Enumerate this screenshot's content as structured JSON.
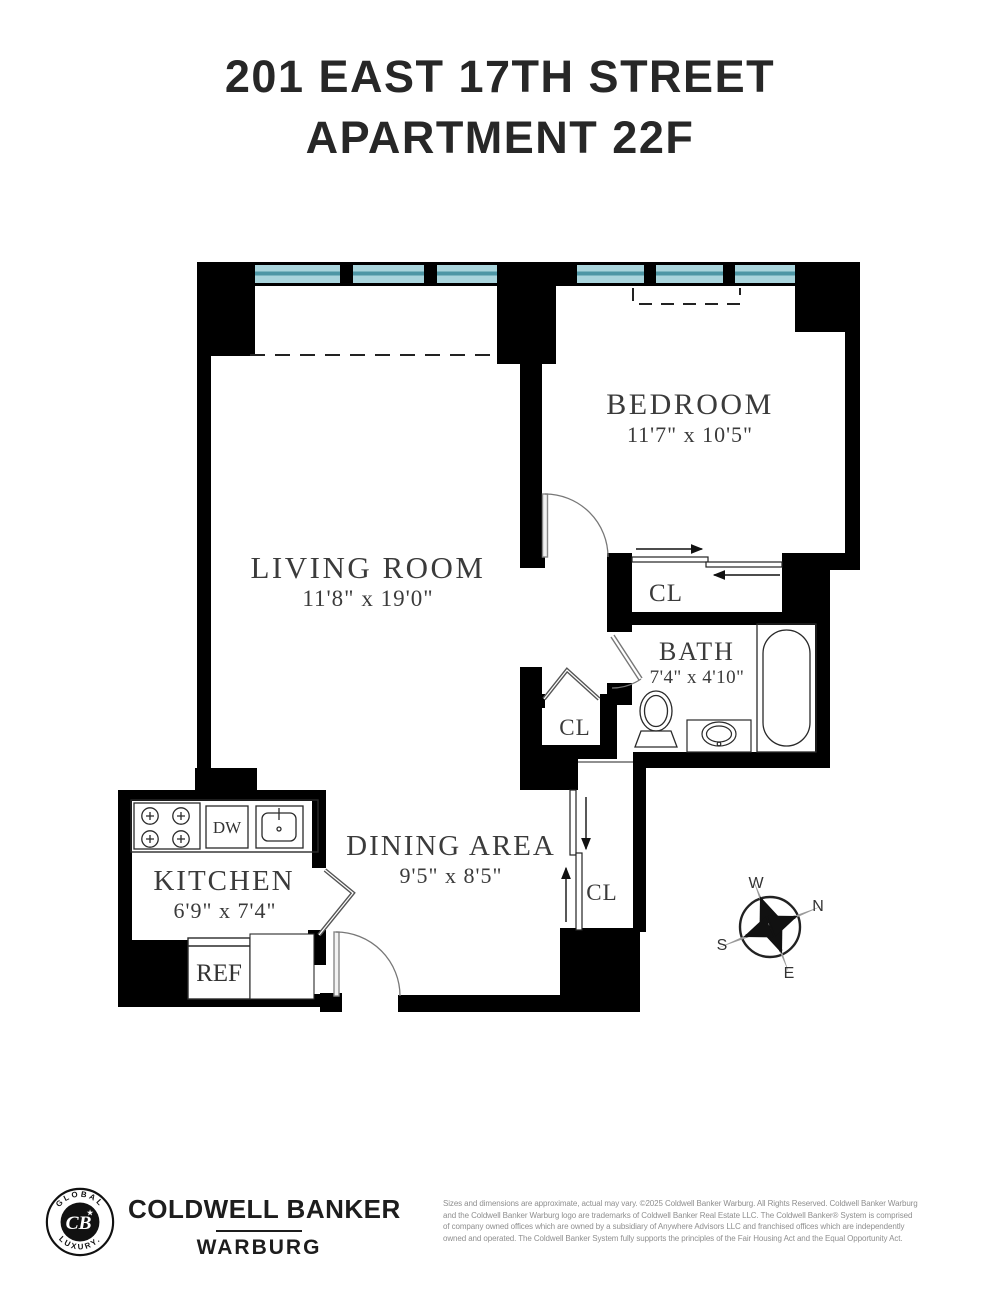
{
  "title": {
    "line1": "201 EAST 17TH STREET",
    "line2": "APARTMENT 22F"
  },
  "rooms": {
    "living_room": {
      "name": "LIVING ROOM",
      "dimensions": "11'8\" x 19'0\""
    },
    "bedroom": {
      "name": "BEDROOM",
      "dimensions": "11'7\" x 10'5\""
    },
    "bath": {
      "name": "BATH",
      "dimensions": "7'4\" x 4'10\""
    },
    "kitchen": {
      "name": "KITCHEN",
      "dimensions": "6'9\" x 7'4\""
    },
    "dining_area": {
      "name": "DINING AREA",
      "dimensions": "9'5\" x 8'5\""
    }
  },
  "closets": {
    "bedroom_closet": "CL",
    "hall_closet": "CL",
    "entry_closet": "CL"
  },
  "fixtures": {
    "dishwasher": "DW",
    "refrigerator": "REF"
  },
  "compass": {
    "north": "N",
    "south": "S",
    "east": "E",
    "west": "W"
  },
  "footer": {
    "brand_line1": "COLDWELL BANKER",
    "brand_line2": "WARBURG",
    "badge": {
      "top": "GLOBAL",
      "bottom": "LUXURY.",
      "monogram": "CB",
      "star": "★"
    },
    "disclaimer_lines": [
      "Sizes and dimensions are approximate, actual may vary. ©2025 Coldwell Banker Warburg. All Rights Reserved. Coldwell Banker Warburg",
      "and the Coldwell Banker Warburg logo are trademarks of Coldwell Banker Real Estate LLC. The Coldwell Banker® System is comprised",
      "of company owned offices which are owned by a subsidiary of Anywhere Advisors LLC and franchised offices which are independently",
      "owned and operated. The Coldwell Banker System fully supports the principles of the Fair Housing Act and the Equal Opportunity Act."
    ]
  },
  "colors": {
    "wall": "#000000",
    "window_glass": "#a9d4dc",
    "window_stripe": "#4d96a5",
    "title_text": "#272727",
    "room_text": "#3b3b3b",
    "disclaimer_text": "#8f8f8f"
  }
}
